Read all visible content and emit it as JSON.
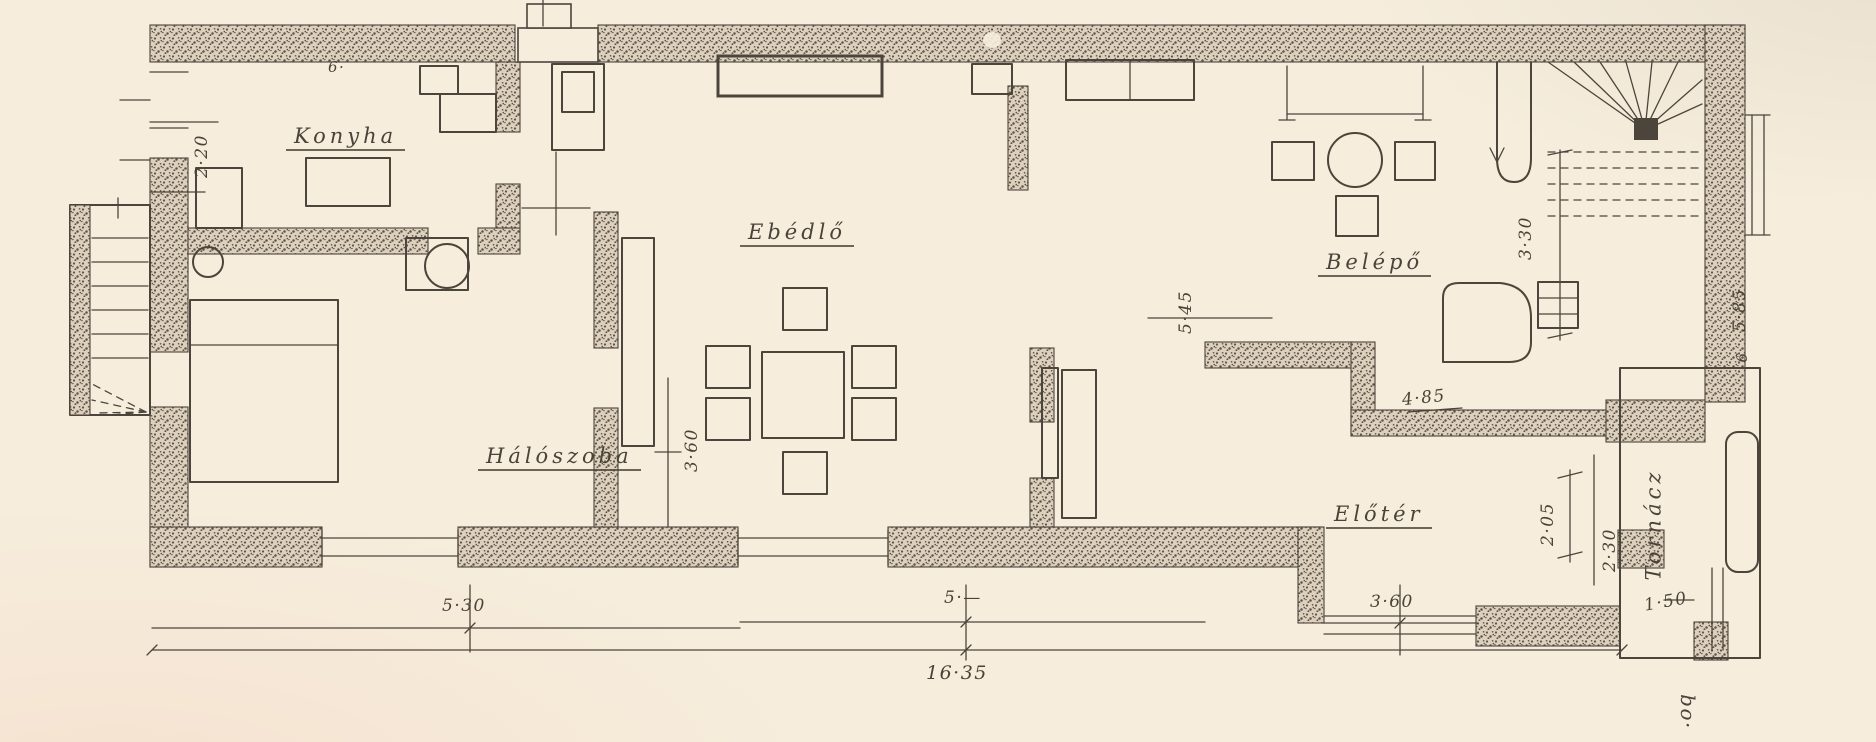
{
  "theme": {
    "paper": "#f6eddc",
    "ink": "#4c453c",
    "wall_base": "#ddd1bd",
    "wall_dot": "#5c544a",
    "label_ink": "#4a4339"
  },
  "drawing": {
    "kind": "hand-drawn house floor plan (scanned)"
  },
  "rooms": {
    "konyha": "Konyha",
    "haloszoba": "Hálószoba",
    "ebedlo": "Ebédlő",
    "belepo": "Belépő",
    "eloter": "Előtér",
    "tornac": "Tornácz"
  },
  "dimensions": {
    "kitchen_height": "2·20",
    "kitchen_mark": "6·",
    "bedroom_width": "5·30",
    "bedroom_wall": "3·60",
    "dining_height": "5·45",
    "dining_width": "5·—",
    "total_width": "16·35",
    "entry_height": "3·30",
    "entry_width": "4·85",
    "right_total": "5·85",
    "right_mark": "6",
    "foyer_height": "2·05",
    "porch_width": "2·30",
    "porch_step": "1·50",
    "foyer_width": "3·60"
  },
  "annotations": {
    "signature": "bo·"
  }
}
